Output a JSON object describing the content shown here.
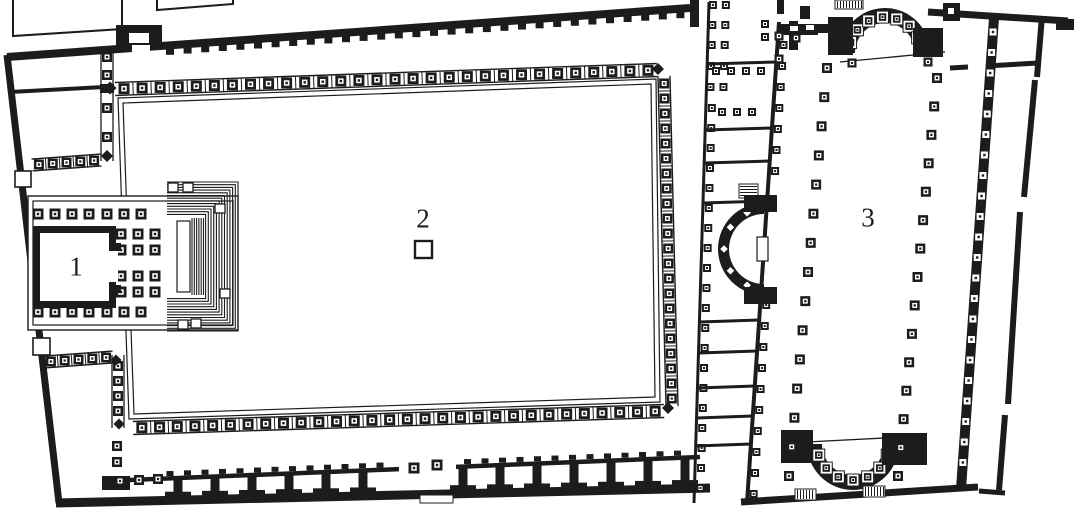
{
  "figure": {
    "title": "Scanned architectural floor plan: temple (1), colonnaded courtyard with altar (2), basilica hall (3)",
    "ink": "#1c1c1c",
    "paper": "#ffffff",
    "canvas": {
      "w": 1086,
      "h": 520
    }
  },
  "plan": {
    "labels": [
      {
        "text": "1",
        "x": 76,
        "y": 268,
        "area": "temple-cella"
      },
      {
        "text": "2",
        "x": 423,
        "y": 220,
        "area": "courtyard-altar"
      },
      {
        "text": "3",
        "x": 868,
        "y": 219,
        "area": "basilica-hall"
      }
    ],
    "altar": {
      "x": 415,
      "y": 241,
      "size": 17
    },
    "outer": {
      "top_wall": [
        7,
        57,
        690,
        8,
        8
      ],
      "left_wall": [
        7,
        55,
        59,
        503,
        7
      ],
      "bottom_wall": [
        56,
        503,
        710,
        488,
        9
      ],
      "top_right_wall": [
        928,
        12,
        1068,
        21,
        7
      ],
      "end_block": [
        1056,
        19,
        18,
        11
      ],
      "gate_block": [
        116,
        25,
        46,
        22
      ],
      "gate_notch": [
        129,
        33,
        20,
        10
      ],
      "gate_gap": [
        132,
        45,
        18,
        9
      ],
      "ticks": {
        "x1": 170,
        "x2": 688,
        "step": 17.6,
        "w": 8,
        "h": 6
      },
      "annex_outlines": [
        [
          [
            13,
            0
          ],
          [
            13,
            36
          ],
          [
            122,
            29
          ],
          [
            122,
            0
          ]
        ],
        [
          [
            157,
            0
          ],
          [
            157,
            10
          ],
          [
            233,
            4
          ],
          [
            233,
            0
          ]
        ]
      ],
      "doors": [
        [
          15,
          171,
          16,
          16
        ],
        [
          33,
          338,
          17,
          17
        ]
      ],
      "nw_divider": [
        10,
        92,
        104,
        87,
        4
      ]
    },
    "west_porticoes": {
      "nw_ladder": {
        "xl": 101,
        "xr": 113,
        "y1": 48,
        "y2": 161,
        "squares_y": [
          57,
          75,
          108,
          137
        ],
        "joint": [
          100,
          84,
          14,
          9
        ],
        "blob": [
          107,
          156,
          12
        ]
      },
      "nw_band": {
        "from": [
          32,
          165
        ],
        "to": [
          101,
          160
        ],
        "w": 12,
        "n": 5,
        "s": 10
      },
      "sw_band": {
        "from": [
          44,
          362
        ],
        "to": [
          113,
          357
        ],
        "w": 12,
        "n": 5,
        "s": 10
      },
      "sw_ladder": {
        "xl": 112,
        "xr": 124,
        "y1": 355,
        "y2": 428,
        "squares_y": [
          366,
          381,
          396,
          411
        ],
        "blobs": [
          [
            116,
            360,
            11
          ],
          [
            119,
            424,
            11
          ]
        ]
      },
      "stray_squares": [
        [
          117,
          446
        ],
        [
          117,
          462
        ]
      ]
    },
    "courtyard": {
      "border_outer": [
        [
          118,
          98
        ],
        [
          656,
          79
        ],
        [
          660,
          402
        ],
        [
          129,
          419
        ]
      ],
      "border_inner": [
        [
          123,
          103
        ],
        [
          651,
          84
        ],
        [
          655,
          397
        ],
        [
          134,
          414
        ]
      ],
      "band_north": {
        "from": [
          115,
          89
        ],
        "to": [
          657,
          70
        ],
        "w": 13,
        "n": 30,
        "s": 11
      },
      "band_east": {
        "from": [
          664,
          76
        ],
        "to": [
          672,
          406
        ],
        "w": 12,
        "n": 22,
        "s": 10
      },
      "band_south": {
        "from": [
          133,
          428
        ],
        "to": [
          664,
          411
        ],
        "w": 13,
        "n": 30,
        "s": 11
      },
      "corner_blobs": [
        [
          110,
          88,
          13
        ],
        [
          658,
          69,
          12
        ],
        [
          668,
          408,
          12
        ]
      ]
    },
    "temple": {
      "platform_outer": [
        28,
        196,
        210,
        134
      ],
      "platform_inner": [
        33,
        201,
        200,
        124
      ],
      "col_rows_x": [
        38,
        55,
        72,
        89,
        107,
        124,
        141
      ],
      "row_top_y": 214,
      "row_bottom_y": 312,
      "grid_x": [
        121,
        138,
        155
      ],
      "grid_y": [
        234,
        250,
        276,
        292
      ],
      "col_size": 11,
      "cella_outer": [
        33,
        226,
        83,
        82
      ],
      "cella_inner": [
        40,
        233,
        69,
        68
      ],
      "door_gap": [
        106,
        250,
        12,
        32
      ],
      "antae": [
        [
          109,
          243,
          12,
          8
        ],
        [
          109,
          285,
          12,
          8
        ]
      ],
      "stairs": {
        "x": 167,
        "y": 182,
        "wdt": 71,
        "hgt": 149,
        "steps": 13,
        "inset": 2.7,
        "flight_x1": 192,
        "flight_x2": 204,
        "flight_step": 2.3,
        "slot": [
          177,
          221,
          13,
          71
        ],
        "notches": [
          [
            168,
            183,
            10,
            9
          ],
          [
            183,
            183,
            10,
            9
          ],
          [
            215,
            204,
            10,
            9
          ],
          [
            220,
            289,
            10,
            9
          ],
          [
            178,
            320,
            10,
            9
          ],
          [
            191,
            319,
            10,
            9
          ]
        ]
      }
    },
    "south_portico": {
      "beam": {
        "xa": 104,
        "ya": 481,
        "xb": 700,
        "yb": 457,
        "w": 4.5,
        "gap": [
          399,
          456
        ]
      },
      "left_block": [
        102,
        476,
        28,
        14
      ],
      "beam_squares": [
        [
          120,
          481
        ],
        [
          139,
          480
        ],
        [
          158,
          479
        ]
      ],
      "tick_step": 17.5,
      "pier_x": [
        178,
        215,
        252,
        289,
        326,
        363,
        463,
        500,
        537,
        574,
        611,
        648,
        685
      ],
      "gap_squares": [
        [
          414,
          468
        ],
        [
          437,
          465
        ]
      ],
      "threshold": [
        420,
        495,
        33,
        8
      ]
    },
    "annex": {
      "west_wall": {
        "x1": 709,
        "y1": 2,
        "x2": 694,
        "y2": 503,
        "w": 3
      },
      "east_wall": {
        "x1": 779,
        "y1": 22,
        "x2": 747,
        "y2": 503,
        "w": 4
      },
      "top_bar": [
        690,
        0,
        9,
        27
      ],
      "pair_rows_y": [
        5,
        25,
        45,
        66,
        87
      ],
      "pair_dx": [
        4,
        17
      ],
      "single_from": 108,
      "single_to": 488,
      "single_step": 20,
      "east_singles_y": [
        45,
        66,
        87,
        108,
        129,
        150,
        171,
        305,
        326,
        347,
        368,
        389,
        410,
        431,
        452,
        473,
        494
      ],
      "dividers_y": [
        64,
        130,
        163,
        203,
        322,
        353,
        388,
        418,
        446
      ],
      "divider_squares": [
        {
          "y": 71,
          "x": [
            716,
            731,
            746,
            761
          ]
        },
        {
          "y": 112,
          "x": [
            722,
            737,
            752
          ]
        }
      ],
      "cross_rects": [
        [
          777,
          27,
          41,
          8
        ],
        [
          789,
          21,
          9,
          29
        ]
      ],
      "cross_squares": [
        [
          765,
          24
        ],
        [
          765,
          37
        ]
      ],
      "top_bars": [
        [
          777,
          0,
          7,
          14
        ],
        [
          800,
          6,
          10,
          13
        ]
      ],
      "stair_hatch": [
        739,
        184,
        19,
        14
      ],
      "exedra": {
        "cx": 764,
        "cy": 249,
        "r_out": 46,
        "r_in": 35,
        "a0": 90,
        "a1": 270,
        "diamond_angles": [
          115,
          147,
          180,
          213,
          245
        ],
        "diamond_r": 40,
        "diamond_s": 9,
        "slot": [
          757,
          237,
          11,
          24
        ],
        "piers": [
          [
            744,
            195,
            33,
            17
          ],
          [
            744,
            287,
            33,
            17
          ]
        ]
      }
    },
    "basilica": {
      "north_apse": {
        "cx": 885,
        "cy": 53,
        "r_out": 45,
        "r_in": 30,
        "a0": 180,
        "a1": 360,
        "box_angles": [
          197,
          220,
          243,
          266,
          289,
          312,
          335
        ],
        "box_r": 36,
        "box_s": 12,
        "chord": [
          840,
          62,
          945,
          52
        ],
        "piers": [
          [
            828,
            17,
            25,
            38
          ],
          [
            913,
            28,
            30,
            29
          ]
        ],
        "mouth_squares": [
          [
            852,
            63
          ],
          [
            928,
            62
          ]
        ],
        "hatch_block": [
          835,
          0,
          28,
          9
        ],
        "flank_wall": [
          779,
          24,
          52,
          9
        ],
        "flank_notches": [
          [
            790,
            26,
            8,
            5
          ],
          [
            806,
            25,
            8,
            5
          ]
        ],
        "flank_squares": [
          [
            779,
            36
          ],
          [
            779,
            59
          ],
          [
            796,
            38
          ]
        ]
      },
      "south_apse": {
        "cx": 853,
        "cy": 444,
        "r_out": 46,
        "r_in": 31,
        "a0": 0,
        "a1": 180,
        "box_angles": [
          18,
          42,
          66,
          90,
          114,
          138,
          162
        ],
        "box_r": 36,
        "box_s": 12,
        "chord": [
          807,
          442,
          903,
          437
        ],
        "piers": [
          [
            781,
            430,
            32,
            33
          ],
          [
            882,
            433,
            45,
            32
          ]
        ]
      },
      "row_left": {
        "x1": 827,
        "y1": 68,
        "x2": 789,
        "y2": 476,
        "n": 15
      },
      "row_right": {
        "x1": 937,
        "y1": 78,
        "x2": 898,
        "y2": 476,
        "n": 15
      },
      "col_size": 10,
      "east_wall": {
        "x1": 994,
        "y1": 18,
        "x2": 961,
        "y2": 489,
        "w": 10,
        "box_from": 32,
        "box_to": 480,
        "box_step": 20.5,
        "box_s": 7
      },
      "east_top_block": [
        943,
        3,
        17,
        18
      ],
      "cross_segs": [
        [
          950,
          68,
          968,
          67,
          5
        ],
        [
          986,
          66,
          1038,
          63,
          5
        ]
      ],
      "bottom_wall": [
        741,
        502,
        978,
        487,
        7
      ],
      "hatch_rects": [
        [
          795,
          489,
          21,
          11
        ],
        [
          863,
          486,
          22,
          11
        ]
      ]
    },
    "boundary": {
      "segs": [
        [
          1042,
          16,
          1037,
          77,
          6
        ],
        [
          1035,
          80,
          1024,
          197,
          6
        ],
        [
          1020,
          212,
          1008,
          404,
          6
        ],
        [
          1005,
          415,
          999,
          490,
          6
        ]
      ],
      "stub": [
        979,
        491,
        1005,
        493,
        5
      ]
    }
  }
}
